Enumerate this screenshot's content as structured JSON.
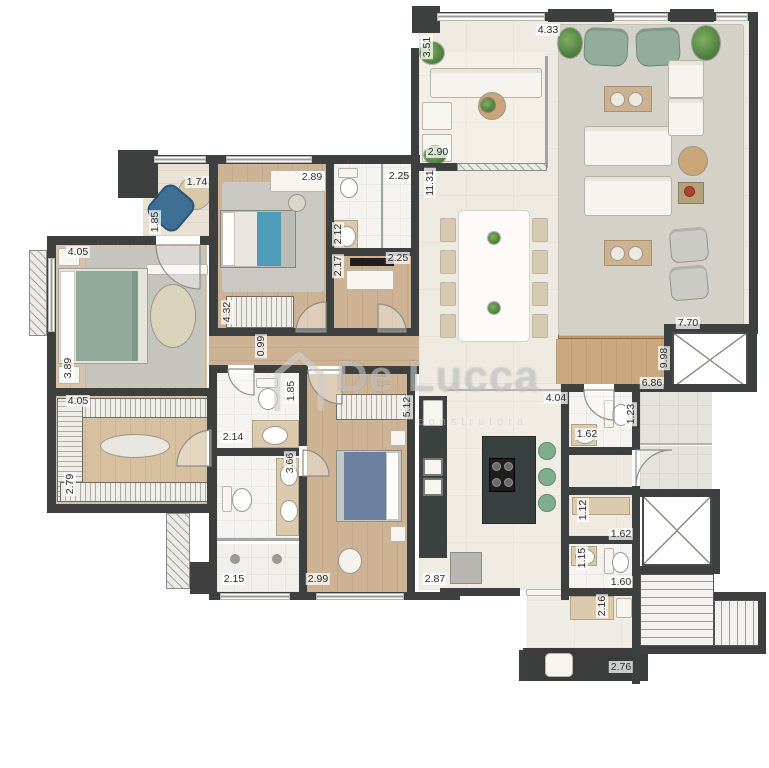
{
  "watermark": {
    "brand": "De Lucca",
    "sub": "construtora"
  },
  "colors": {
    "wall": "#3e3f3f",
    "wood_floor": "#cdb394",
    "beige_tile": "#efeae1",
    "bath_tile": "#f4f3f0",
    "rug_gray": "#c9c7c2",
    "counter_dark": "#3c4240",
    "bed_green": "#8fa99a",
    "bed_blue": "#6b7f9e",
    "accent_teal": "#4e9cb8",
    "stool_green": "#7fae8e",
    "tan_counter": "#dccaae"
  },
  "dims": [
    {
      "t": "1.74",
      "x": 197,
      "y": 182,
      "v": false
    },
    {
      "t": "1.85",
      "x": 155,
      "y": 222,
      "v": true
    },
    {
      "t": "2.89",
      "x": 312,
      "y": 177,
      "v": false
    },
    {
      "t": "2.25",
      "x": 399,
      "y": 176,
      "v": false
    },
    {
      "t": "2.12",
      "x": 338,
      "y": 234,
      "v": true
    },
    {
      "t": "2.17",
      "x": 338,
      "y": 266,
      "v": true
    },
    {
      "t": "2.25",
      "x": 398,
      "y": 258,
      "v": false
    },
    {
      "t": "3.51",
      "x": 427,
      "y": 47,
      "v": true
    },
    {
      "t": "2.90",
      "x": 438,
      "y": 152,
      "v": false
    },
    {
      "t": "4.33",
      "x": 548,
      "y": 30,
      "v": false
    },
    {
      "t": "11.31",
      "x": 430,
      "y": 183,
      "v": true
    },
    {
      "t": "7.70",
      "x": 688,
      "y": 323,
      "v": false
    },
    {
      "t": "9.98",
      "x": 664,
      "y": 358,
      "v": true
    },
    {
      "t": "6.86",
      "x": 652,
      "y": 383,
      "v": false
    },
    {
      "t": "4.05",
      "x": 78,
      "y": 252,
      "v": false
    },
    {
      "t": "3.89",
      "x": 68,
      "y": 368,
      "v": true
    },
    {
      "t": "4.32",
      "x": 227,
      "y": 312,
      "v": true
    },
    {
      "t": "0.99",
      "x": 261,
      "y": 346,
      "v": true
    },
    {
      "t": "1.85",
      "x": 291,
      "y": 391,
      "v": true
    },
    {
      "t": "2.14",
      "x": 233,
      "y": 437,
      "v": false
    },
    {
      "t": "3.66",
      "x": 290,
      "y": 463,
      "v": true
    },
    {
      "t": "2.15",
      "x": 234,
      "y": 579,
      "v": false
    },
    {
      "t": "2.99",
      "x": 318,
      "y": 579,
      "v": false
    },
    {
      "t": "5.12",
      "x": 407,
      "y": 407,
      "v": true
    },
    {
      "t": "4.05",
      "x": 78,
      "y": 401,
      "v": false
    },
    {
      "t": "2.79",
      "x": 70,
      "y": 484,
      "v": true
    },
    {
      "t": "4.04",
      "x": 556,
      "y": 398,
      "v": false
    },
    {
      "t": "2.87",
      "x": 435,
      "y": 579,
      "v": false
    },
    {
      "t": "1.62",
      "x": 587,
      "y": 434,
      "v": false
    },
    {
      "t": "1.23",
      "x": 631,
      "y": 414,
      "v": true
    },
    {
      "t": "1.12",
      "x": 583,
      "y": 510,
      "v": true
    },
    {
      "t": "1.62",
      "x": 621,
      "y": 534,
      "v": false
    },
    {
      "t": "1.15",
      "x": 582,
      "y": 558,
      "v": true
    },
    {
      "t": "1.60",
      "x": 621,
      "y": 582,
      "v": false
    },
    {
      "t": "2.16",
      "x": 602,
      "y": 606,
      "v": true
    },
    {
      "t": "2.76",
      "x": 621,
      "y": 667,
      "v": false
    }
  ]
}
